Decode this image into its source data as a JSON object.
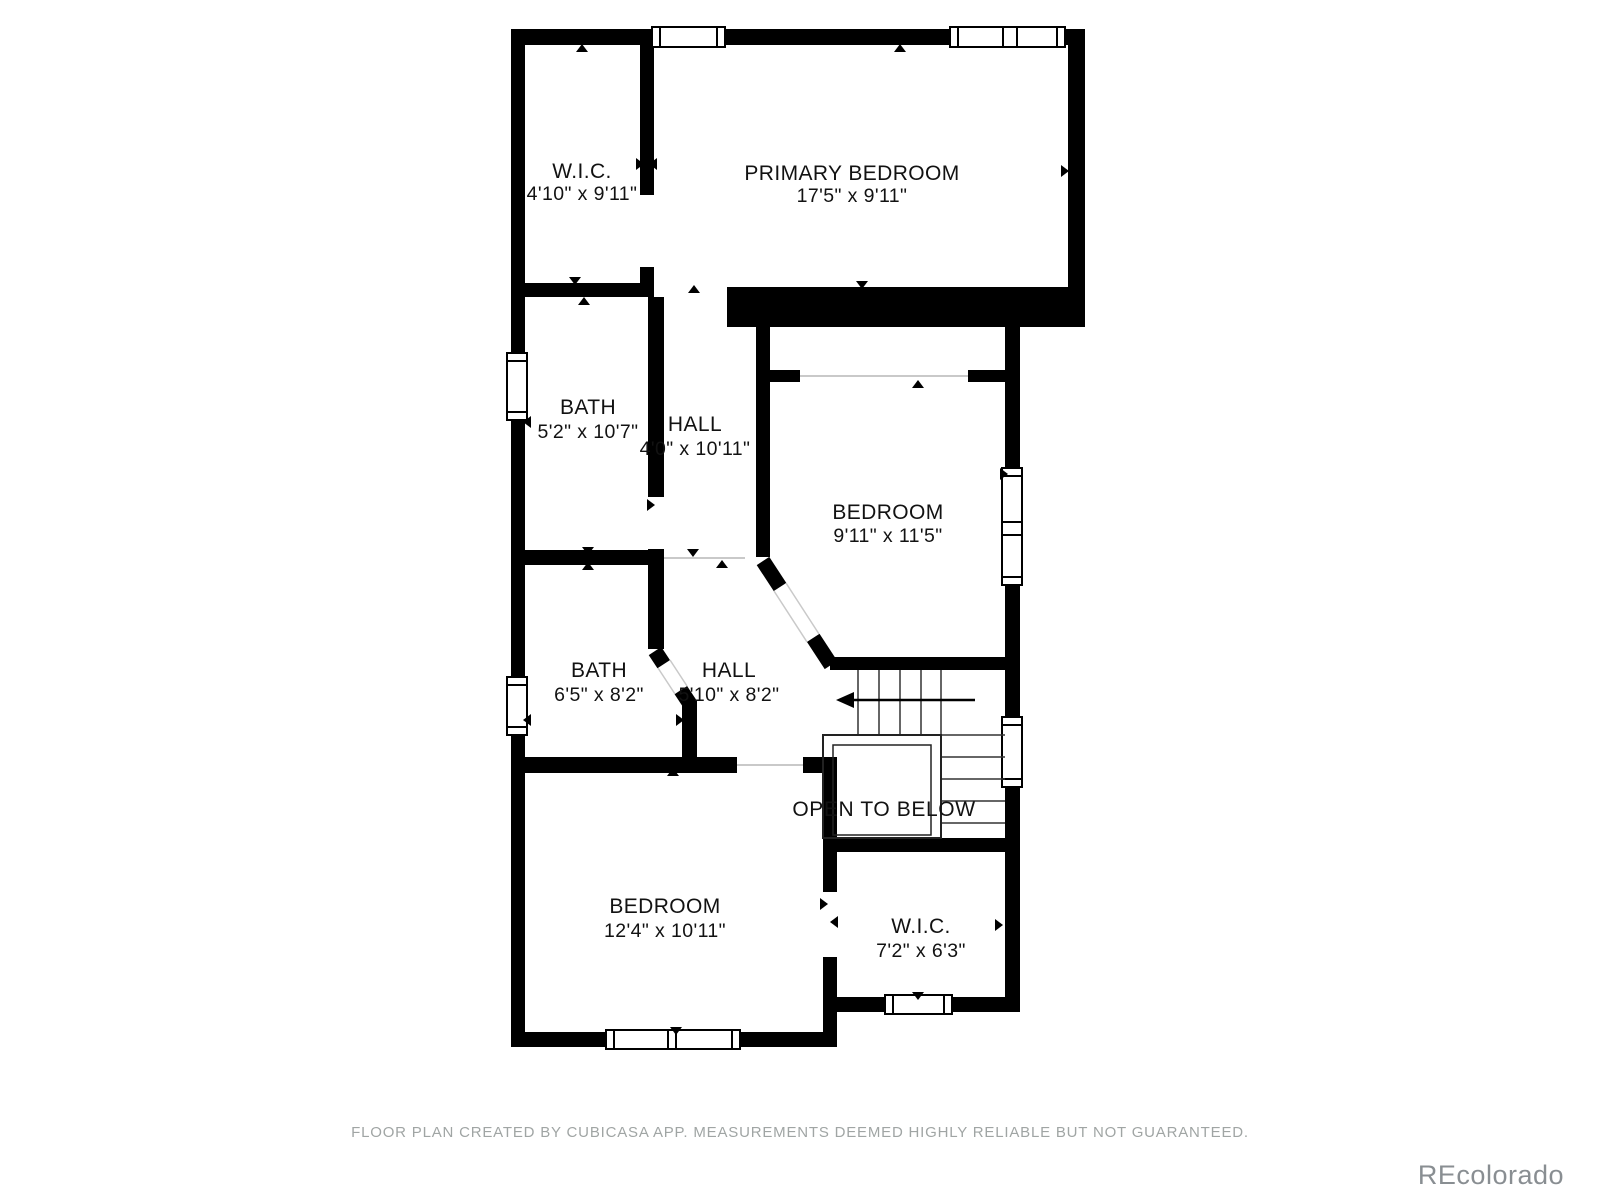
{
  "plan": {
    "rooms": [
      {
        "id": "wic-upper",
        "name": "W.I.C.",
        "dims": "4'10\" x 9'11\""
      },
      {
        "id": "primary-bedroom",
        "name": "PRIMARY BEDROOM",
        "dims": "17'5\" x 9'11\""
      },
      {
        "id": "bath-upper",
        "name": "BATH",
        "dims": "5'2\" x 10'7\""
      },
      {
        "id": "hall-upper",
        "name": "HALL",
        "dims": "4'0\" x 10'11\""
      },
      {
        "id": "bedroom-right",
        "name": "BEDROOM",
        "dims": "9'11\" x 11'5\""
      },
      {
        "id": "bath-lower",
        "name": "BATH",
        "dims": "6'5\" x 8'2\""
      },
      {
        "id": "hall-lower",
        "name": "HALL",
        "dims": "5'10\" x 8'2\""
      },
      {
        "id": "bedroom-lower",
        "name": "BEDROOM",
        "dims": "12'4\" x 10'11\""
      },
      {
        "id": "wic-lower",
        "name": "W.I.C.",
        "dims": "7'2\" x 6'3\""
      }
    ],
    "annotations": {
      "open_to_below": "OPEN TO BELOW"
    }
  },
  "footer": {
    "disclaimer": "FLOOR PLAN CREATED BY CUBICASA APP. MEASUREMENTS DEEMED HIGHLY RELIABLE BUT NOT GUARANTEED."
  },
  "watermark": {
    "text": "REcolorado"
  },
  "colors": {
    "wall": "#000000",
    "label": "#121212",
    "opening_line": "#c9c9c9",
    "stair_line": "#333333",
    "footer_text": "#a0a5a4",
    "watermark_text": "#898e92",
    "background": "#ffffff"
  }
}
